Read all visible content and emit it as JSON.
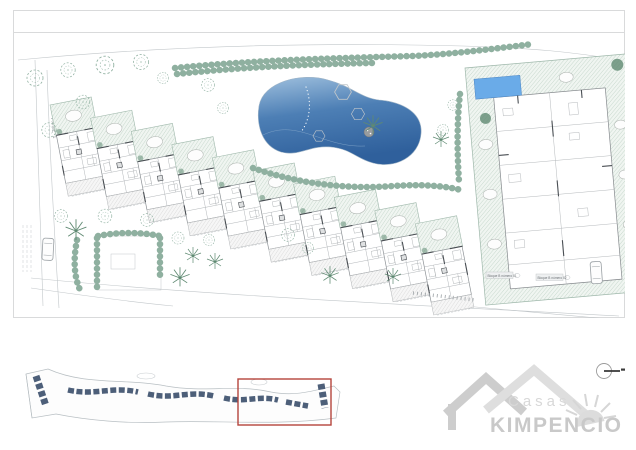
{
  "plan": {
    "phase_label": "FASE 1",
    "block_labels": [
      "Bloque B número 01",
      "Bloque B número 02"
    ]
  },
  "key_plan": {
    "highlight_color": "#b5443c"
  },
  "logo": {
    "brand_top": "Casas",
    "brand_main": "KIMPENCIO"
  },
  "icons": {
    "sun": "sun-icon",
    "compass": "compass-marker-icon",
    "tree": "tree-icon",
    "palm": "palm-tree-icon"
  },
  "colors": {
    "paper": "#ffffff",
    "frame-line": "#d9dadb",
    "draw-line": "#c2c7ca",
    "wall-dark": "#4a4f54",
    "veg-green": "#8fb0a0",
    "veg-dark": "#5f8a72",
    "hatch-green-line": "#b7cdbf",
    "hatch-gray-line": "#d2d2d2",
    "pool-light": "#9fc0de",
    "pool-dark": "#2f609c",
    "pool-small": "#6aabe8",
    "slate-building": "#4d5f79",
    "highlight-red": "#b5443c",
    "logo-gray": "#cdcdcd",
    "label-gray": "#8a8f93"
  }
}
